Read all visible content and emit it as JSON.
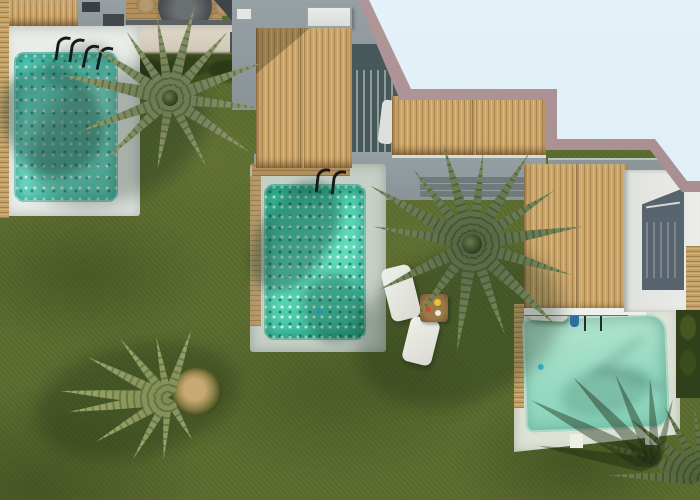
{
  "scene": {
    "type": "aerial-photograph",
    "description": "Top-down drone view of resort villas with thatched roofs, three private pools, lawns and palm trees; photo has a stepped mauve border over a pale-blue page background at top right",
    "objects": [
      "thatched-roof-villa-1",
      "thatched-roof-villa-2",
      "thatched-roof-villa-3",
      "pool-1-top-left",
      "pool-2-center",
      "pool-3-bottom-right",
      "palm-tree-1",
      "palm-tree-2",
      "palm-tree-3",
      "palm-shadow-bottom-right",
      "lawn",
      "sun-loungers",
      "round-dining-table",
      "food-tray-table",
      "pool-ladders",
      "swimmer",
      "hedge",
      "terraces",
      "glass-doors",
      "roof-vent"
    ],
    "colors": {
      "grass": "#5c6c2e",
      "grass_dark": "#3f4e1a",
      "pool1_water": "#5fd9c0",
      "pool2_water": "#2fbf9b",
      "pool3_water": "#9cdcc3",
      "deck_white": "#e9ece8",
      "deck_gray_green": "#c7d0c7",
      "deck_pale": "#dde2d6",
      "thatch": "#c9a569",
      "thatch_shadow": "#8a6b3a",
      "concrete": "#8f989c",
      "dark_glass_wall": "#46585a",
      "courtyard_wall": "#57636d",
      "white_building": "#e7e8e4",
      "border_mauve": "#ab9193",
      "background_blue": "#e1eff7",
      "hedge_green": "#37471d",
      "palm_green": "#55683f",
      "palm_yellow_green": "#7d8b51",
      "wood": "#b2905c",
      "table_wood": "#8a6a3e",
      "swimmer_blue": "#2e6ea6"
    },
    "palms": [
      {
        "name": "palm-tree-1",
        "x": 170,
        "y": 98,
        "color": "#66754e",
        "tip": "#8d9769",
        "crown": 16,
        "fronds": [
          [
            -168,
            112
          ],
          [
            -146,
            92
          ],
          [
            -123,
            80
          ],
          [
            -99,
            84
          ],
          [
            -75,
            96
          ],
          [
            -49,
            88
          ],
          [
            -21,
            100
          ],
          [
            6,
            92
          ],
          [
            34,
            96
          ],
          [
            62,
            78
          ],
          [
            100,
            72
          ],
          [
            136,
            88
          ],
          [
            160,
            96
          ]
        ]
      },
      {
        "name": "palm-tree-2",
        "x": 472,
        "y": 244,
        "color": "#4f6340",
        "tip": "#77875a",
        "crown": 20,
        "fronds": [
          [
            -170,
            100
          ],
          [
            -150,
            118
          ],
          [
            -128,
            96
          ],
          [
            -106,
            104
          ],
          [
            -83,
            92
          ],
          [
            -58,
            108
          ],
          [
            -33,
            98
          ],
          [
            -9,
            112
          ],
          [
            17,
            104
          ],
          [
            44,
            116
          ],
          [
            70,
            96
          ],
          [
            98,
            108
          ],
          [
            127,
            92
          ],
          [
            154,
            104
          ]
        ]
      },
      {
        "name": "palm-tree-3",
        "x": 168,
        "y": 398,
        "color": "#7d8b51",
        "tip": "#9aa668",
        "crown": 0,
        "fronds": [
          [
            -176,
            108
          ],
          [
            -153,
            90
          ],
          [
            -129,
            76
          ],
          [
            -101,
            62
          ],
          [
            -71,
            72
          ],
          [
            172,
            100
          ],
          [
            149,
            84
          ],
          [
            120,
            70
          ],
          [
            94,
            62
          ],
          [
            60,
            48
          ]
        ]
      },
      {
        "name": "palm-tree-4",
        "x": 704,
        "y": 478,
        "color": "#4d6038",
        "tip": "#6c7c4c",
        "crown": 0,
        "fronds": [
          [
            -178,
            96
          ],
          [
            -161,
            112
          ],
          [
            -141,
            94
          ],
          [
            -119,
            82
          ],
          [
            -98,
            72
          ]
        ]
      }
    ],
    "shadow_palms": [
      {
        "name": "palm-shadow-bottom-right",
        "x": 656,
        "y": 466,
        "fronds": [
          [
            -170,
            120
          ],
          [
            -152,
            142
          ],
          [
            -133,
            122
          ],
          [
            -114,
            100
          ],
          [
            -94,
            88
          ],
          [
            -76,
            70
          ]
        ]
      }
    ]
  }
}
